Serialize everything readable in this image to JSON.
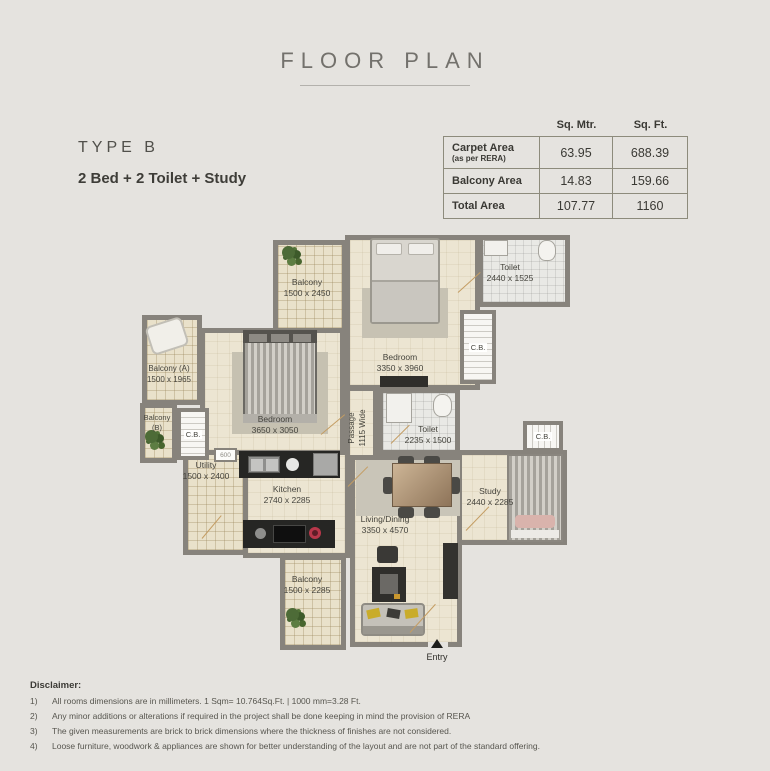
{
  "header": {
    "title": "FLOOR PLAN"
  },
  "unit": {
    "type_label": "TYPE B",
    "configuration": "2 Bed + 2 Toilet + Study"
  },
  "area_table": {
    "columns": [
      "Sq. Mtr.",
      "Sq. Ft."
    ],
    "rows": [
      {
        "label": "Carpet Area",
        "sublabel": "(as per RERA)",
        "sq_mtr": "63.95",
        "sq_ft": "688.39"
      },
      {
        "label": "Balcony Area",
        "sublabel": "",
        "sq_mtr": "14.83",
        "sq_ft": "159.66"
      },
      {
        "label": "Total Area",
        "sublabel": "",
        "sq_mtr": "107.77",
        "sq_ft": "1160"
      }
    ]
  },
  "floor_plan": {
    "rooms": [
      {
        "name": "Balcony",
        "dims": "1500 x 2450"
      },
      {
        "name": "Bedroom",
        "dims": "3350 x 3960"
      },
      {
        "name": "Toilet",
        "dims": "2440 x 1525"
      },
      {
        "name": "C.B."
      },
      {
        "name": "Balcony (A)",
        "dims": "1500 x 1965"
      },
      {
        "name": "Balcony (B)"
      },
      {
        "name": "C.B."
      },
      {
        "name": "Bedroom",
        "dims": "3650 x 3050"
      },
      {
        "name": "Toilet",
        "dims": "2235 x 1500"
      },
      {
        "name": "C.B."
      },
      {
        "name": "Utility",
        "dims": "1500 x 2400"
      },
      {
        "name": "Kitchen",
        "dims": "2740 x 2285"
      },
      {
        "name": "Study",
        "dims": "2440 x 2285"
      },
      {
        "name": "Living/Dining",
        "dims": "3350 x 4570"
      },
      {
        "name": "Balcony",
        "dims": "1500 x 2285"
      }
    ],
    "passage": {
      "name": "Passage",
      "dims": "1115 Wide"
    },
    "entry_label": "Entry",
    "shaft_label": "600"
  },
  "disclaimer": {
    "heading": "Disclaimer:",
    "items": [
      {
        "num": "1)",
        "text": "All rooms dimensions are in millimeters. 1 Sqm= 10.764Sq.Ft. | 1000 mm=3.28 Ft."
      },
      {
        "num": "2)",
        "text": "Any minor additions or alterations if required in the project shall be done keeping in mind the provision of RERA"
      },
      {
        "num": "3)",
        "text": "The given measurements are brick to brick dimensions where the thickness of finishes are not considered."
      },
      {
        "num": "4)",
        "text": "Loose furniture, woodwork & appliances are shown for better understanding of the layout and are not part of the standard offering."
      }
    ]
  }
}
